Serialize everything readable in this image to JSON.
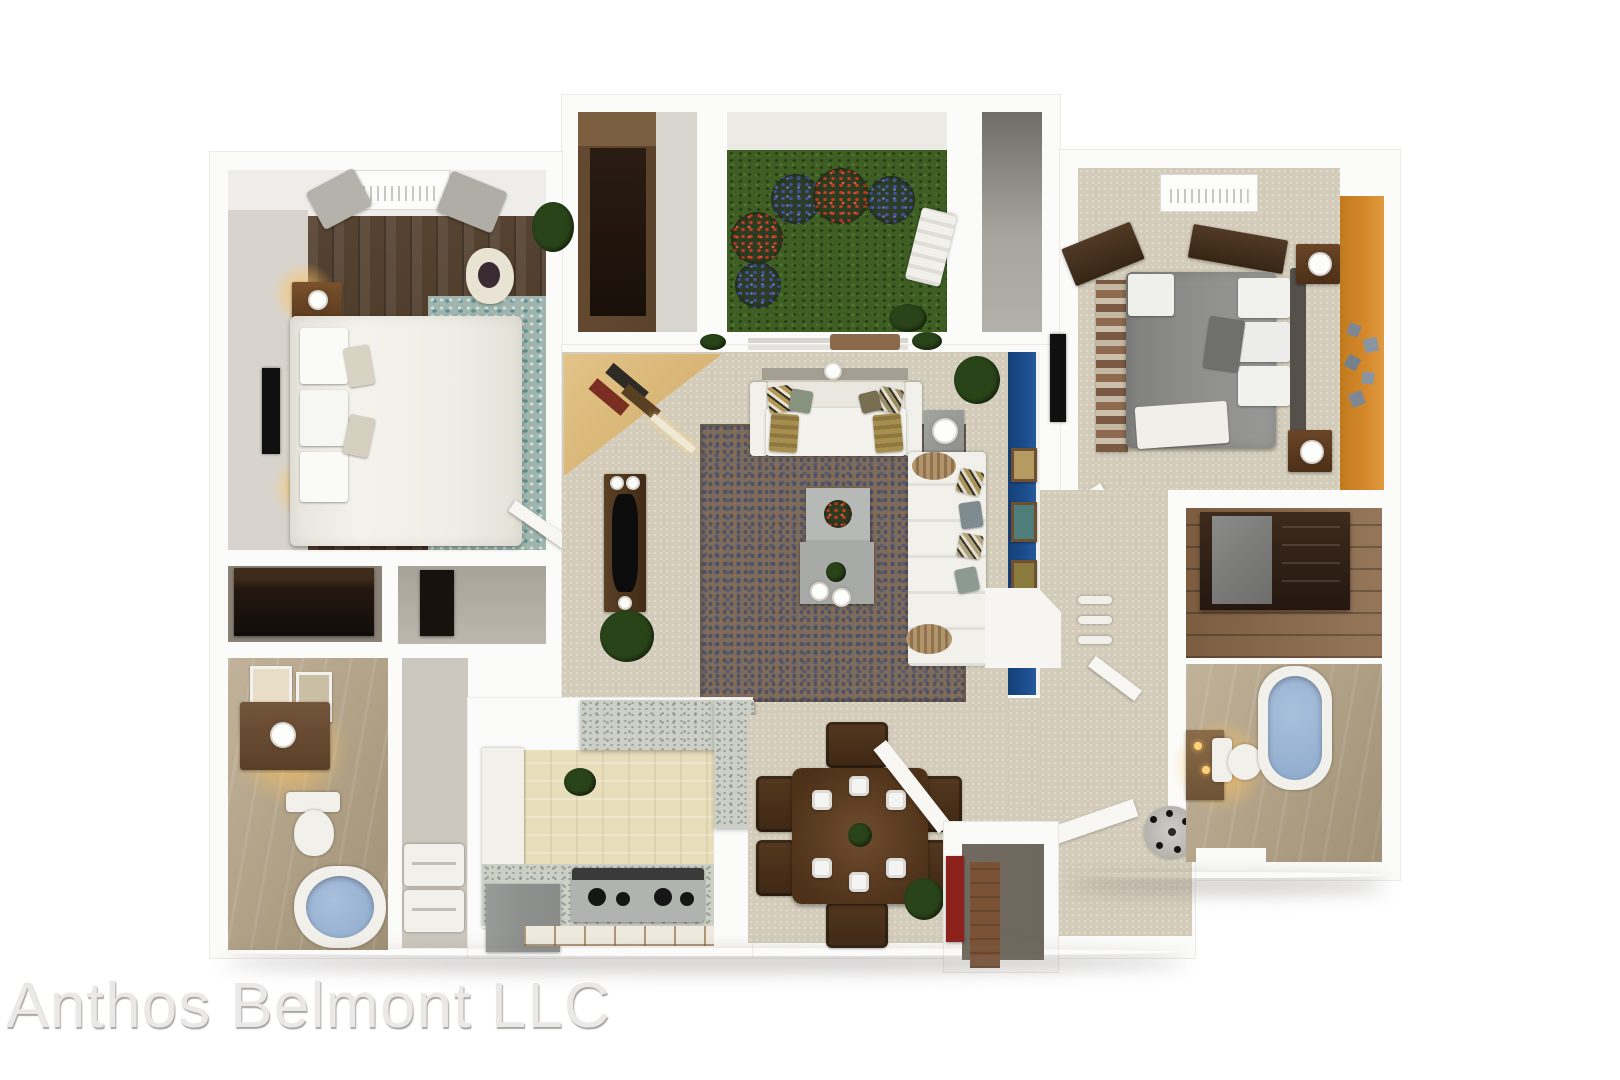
{
  "watermark": {
    "text": "Anthos Belmont LLC"
  },
  "scene": {
    "type": "3D top-down apartment floor plan rendering",
    "rooms": [
      "master-bedroom",
      "master-closet",
      "utility-closet",
      "bathroom-1",
      "laundry-hallway",
      "walk-in-wardrobe",
      "patio",
      "storage-room",
      "bedroom-2",
      "living-room",
      "kitchen",
      "dining-area",
      "entry-closet",
      "entry",
      "hallway",
      "walk-in-closet-2",
      "bathroom-2"
    ],
    "furniture": [
      "master-bed",
      "nightstands-with-lamps",
      "tv-master",
      "accent-chair",
      "teal-area-rug",
      "hvac-unit",
      "wardrobe-cabinet",
      "patio-lounge-chair",
      "flower-bushes",
      "bed-2-gray",
      "striped-runner-rug",
      "wall-flower-decals",
      "tv-bedroom-2",
      "corner-desk-with-books",
      "media-console-tv",
      "sofa-with-pillows",
      "chaise-sectional",
      "coffee-tables",
      "side-table-lamp",
      "area-rug-living",
      "potted-plants",
      "granite-breakfast-bar",
      "stove",
      "refrigerator",
      "dining-table-6-chairs",
      "plates",
      "toilet",
      "bathtub-1",
      "bathtub-2",
      "vanity-lit",
      "washer-dryer",
      "coat-stand",
      "dresser-with-mirror"
    ]
  },
  "palette": {
    "page-bg": "#ffffff",
    "wall": "#fbfbfa",
    "wall-edge": "#eceae6",
    "carpet": "#d3ccba",
    "wood-floor-dark": "#4e3926",
    "wood-floor-mid": "#8a6747",
    "wardrobe-wood": "#5a422c",
    "dark-furniture": "#2c1d12",
    "grass": "#3f5e24",
    "flower-red": "#c23a22",
    "flower-blue": "#42539e",
    "accent-orange": "#d6892b",
    "accent-blue": "#1c4d8d",
    "water-blue": "#8fabcd",
    "granite": "#ccd0c6",
    "bath-tile": "#b3a183",
    "kitchen-beige": "#e8debc",
    "gray-floor": "#8f8e88",
    "white-furniture": "#f2f0ea",
    "gray-bed": "#8e8e8c",
    "rug-brown": "#7d6c5c",
    "rug-teal": "#9fb5ae",
    "glow": "#ffc45c"
  }
}
